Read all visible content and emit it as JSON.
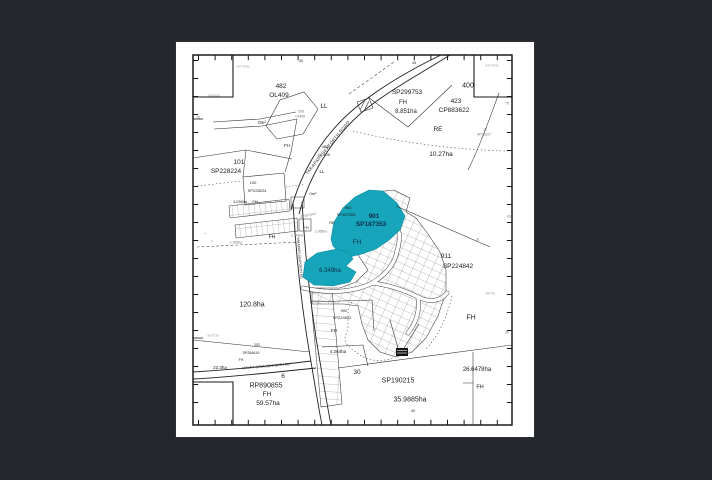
{
  "map": {
    "highlight_color": "#16a5ba",
    "highlight_text_color": "#0d2d4a",
    "paper_color": "#ffffff",
    "background_color": "#24272c",
    "line_color": "#2b2b2b",
    "labels": [
      {
        "t": "482",
        "x": 281,
        "y": 87,
        "s": 6.5,
        "n": "lot-482-number"
      },
      {
        "t": "OL409",
        "x": 279,
        "y": 96,
        "s": 6.5,
        "n": "lot-482-plan"
      },
      {
        "t": "LL",
        "x": 324,
        "y": 107,
        "s": 6,
        "n": "tenure-ll-label"
      },
      {
        "t": "SP299753",
        "x": 407,
        "y": 93,
        "s": 6.5,
        "n": "lot-sp299753-plan"
      },
      {
        "t": "FH",
        "x": 403,
        "y": 103,
        "s": 6,
        "n": "tenure-fh-label"
      },
      {
        "t": "8.851ha",
        "x": 406,
        "y": 112,
        "s": 6,
        "n": "area-8851-label"
      },
      {
        "t": "423",
        "x": 456,
        "y": 102,
        "s": 6.5,
        "n": "lot-423-number"
      },
      {
        "t": "CP883622",
        "x": 454,
        "y": 111,
        "s": 6.5,
        "n": "lot-423-plan"
      },
      {
        "t": "400",
        "x": 468,
        "y": 86,
        "s": 7,
        "n": "lot-400-number"
      },
      {
        "t": "RE",
        "x": 438,
        "y": 130,
        "s": 6.5,
        "n": "tenure-re-label"
      },
      {
        "t": "10.27ha",
        "x": 441,
        "y": 155,
        "s": 6.5,
        "n": "area-1027-label"
      },
      {
        "t": "19",
        "x": 485,
        "y": 130,
        "s": 3.4,
        "c": "#777777"
      },
      {
        "t": "AP22627",
        "x": 484,
        "y": 135,
        "s": 3.4,
        "c": "#777777"
      },
      {
        "t": "101",
        "x": 239,
        "y": 163,
        "s": 6.5,
        "n": "lot-101-number"
      },
      {
        "t": "SP228224",
        "x": 226,
        "y": 172,
        "s": 6.5,
        "n": "lot-101-plan"
      },
      {
        "t": "100",
        "x": 253,
        "y": 183,
        "s": 4
      },
      {
        "t": "SP228224",
        "x": 257,
        "y": 191,
        "s": 4
      },
      {
        "t": "FH",
        "x": 255,
        "y": 202,
        "s": 4
      },
      {
        "t": "0m²",
        "x": 262,
        "y": 123,
        "s": 4.5
      },
      {
        "t": "FH",
        "x": 287,
        "y": 146,
        "s": 4.5
      },
      {
        "t": "598",
        "x": 301,
        "y": 112,
        "s": 3.4,
        "c": "#777777"
      },
      {
        "t": "C4408",
        "x": 300,
        "y": 117,
        "s": 3.4,
        "c": "#777777"
      },
      {
        "t": "482",
        "x": 325,
        "y": 147,
        "s": 4
      },
      {
        "t": "OL409",
        "x": 324,
        "y": 155,
        "s": 4
      },
      {
        "t": "LL",
        "x": 322,
        "y": 172,
        "s": 4.5
      },
      {
        "t": "0m²",
        "x": 313,
        "y": 194,
        "s": 4
      },
      {
        "t": "903",
        "x": 348,
        "y": 208,
        "s": 4
      },
      {
        "t": "SP187353",
        "x": 346,
        "y": 215,
        "s": 4
      },
      {
        "t": "SP187343",
        "x": 308,
        "y": 216,
        "s": 3.4,
        "c": "#777777",
        "r": -12
      },
      {
        "t": "RE",
        "x": 332,
        "y": 223,
        "s": 4
      },
      {
        "t": "FH",
        "x": 306,
        "y": 228,
        "s": 4
      },
      {
        "t": "2.343ha",
        "x": 297,
        "y": 236,
        "s": 3.4,
        "c": "#777777"
      },
      {
        "t": "2.066ha",
        "x": 321,
        "y": 232,
        "s": 3.4,
        "c": "#777777"
      },
      {
        "t": "901",
        "x": 374,
        "y": 217,
        "s": 6.5,
        "c": "#0d2d4a",
        "b": 1,
        "n": "highlight-lot-901-number"
      },
      {
        "t": "SP187353",
        "x": 371,
        "y": 225,
        "s": 6.5,
        "c": "#0d2d4a",
        "b": 1,
        "n": "highlight-lot-901-plan"
      },
      {
        "t": "FH",
        "x": 357,
        "y": 243,
        "s": 6.5,
        "c": "#0d2d4a",
        "n": "highlight-lot-901-tenure"
      },
      {
        "t": "6.349ha",
        "x": 330,
        "y": 271,
        "s": 6,
        "c": "#0d2d4a",
        "n": "highlight-lot-area"
      },
      {
        "t": "911",
        "x": 446,
        "y": 257,
        "s": 6.5,
        "n": "lot-911-number"
      },
      {
        "t": "SP224842",
        "x": 458,
        "y": 267,
        "s": 6.5,
        "n": "lot-911-plan"
      },
      {
        "t": "3L",
        "x": 478,
        "y": 240,
        "s": 3.4,
        "c": "#777777"
      },
      {
        "t": "187ha",
        "x": 490,
        "y": 294,
        "s": 3.4,
        "c": "#999999"
      },
      {
        "t": "FH",
        "x": 471,
        "y": 318,
        "s": 7,
        "n": "tenure-fh-east"
      },
      {
        "t": "120.8ha",
        "x": 252,
        "y": 305,
        "s": 7,
        "n": "area-1208-label"
      },
      {
        "t": "4.036ha",
        "x": 240,
        "y": 203,
        "s": 3.8
      },
      {
        "t": "FH",
        "x": 272,
        "y": 238,
        "s": 5
      },
      {
        "t": "1.009ha",
        "x": 236,
        "y": 243,
        "s": 3.4,
        "c": "#777777"
      },
      {
        "t": "900",
        "x": 344,
        "y": 311,
        "s": 4
      },
      {
        "t": "SP224842",
        "x": 342,
        "y": 318,
        "s": 4
      },
      {
        "t": "FH",
        "x": 334,
        "y": 331,
        "s": 4.5
      },
      {
        "t": "4.264ha",
        "x": 338,
        "y": 352,
        "s": 4.5
      },
      {
        "t": "202",
        "x": 257,
        "y": 346,
        "s": 3.6
      },
      {
        "t": "SP264619",
        "x": 251,
        "y": 354,
        "s": 3.6
      },
      {
        "t": "FH",
        "x": 241,
        "y": 361,
        "s": 3.6
      },
      {
        "t": "22.3ha",
        "x": 220,
        "y": 368,
        "s": 4.5,
        "n": "area-223-label"
      },
      {
        "t": "6",
        "x": 283,
        "y": 377,
        "s": 6.5,
        "n": "lot-6-number"
      },
      {
        "t": "RP890855",
        "x": 266,
        "y": 386,
        "s": 7,
        "n": "lot-6-plan"
      },
      {
        "t": "FH",
        "x": 267,
        "y": 395,
        "s": 6.5
      },
      {
        "t": "59.57ha",
        "x": 268,
        "y": 404,
        "s": 6.5,
        "n": "area-5957-label"
      },
      {
        "t": "30",
        "x": 357,
        "y": 373,
        "s": 6.5,
        "n": "lot-30-number"
      },
      {
        "t": "SP190215",
        "x": 398,
        "y": 381,
        "s": 7,
        "n": "lot-30-plan"
      },
      {
        "t": "35.9885ha",
        "x": 410,
        "y": 400,
        "s": 7,
        "n": "area-359885-label"
      },
      {
        "t": "26.6478ha",
        "x": 477,
        "y": 370,
        "s": 6,
        "n": "area-266478-label"
      },
      {
        "t": "FH",
        "x": 480,
        "y": 388,
        "s": 5.5
      },
      {
        "t": "40",
        "x": 301,
        "y": 61,
        "s": 4,
        "c": "#333333",
        "n": "border-tick-label"
      },
      {
        "t": "45",
        "x": 414,
        "y": 63,
        "s": 4,
        "c": "#333333",
        "n": "border-tick-label"
      },
      {
        "t": "40",
        "x": 413,
        "y": 411,
        "s": 4,
        "c": "#333333",
        "n": "border-tick-label"
      },
      {
        "t": "75",
        "x": 198,
        "y": 118,
        "s": 3.4,
        "c": "#777777"
      },
      {
        "t": "75",
        "x": 507,
        "y": 104,
        "s": 3.4,
        "c": "#777777"
      },
      {
        "t": "63",
        "x": 509,
        "y": 217,
        "s": 3.4,
        "c": "#777777"
      },
      {
        "t": "60",
        "x": 507,
        "y": 333,
        "s": 3.4,
        "c": "#777777"
      },
      {
        "t": "347°5730",
        "x": 243,
        "y": 67,
        "s": 3,
        "c": "#888888",
        "n": "bearing-label"
      },
      {
        "t": "90°5730",
        "x": 214,
        "y": 96,
        "s": 3,
        "c": "#888888",
        "n": "bearing-label"
      },
      {
        "t": "347°5730",
        "x": 492,
        "y": 66,
        "s": 3,
        "c": "#888888",
        "n": "bearing-label"
      },
      {
        "t": "90°5730",
        "x": 213,
        "y": 336,
        "s": 3,
        "c": "#888888",
        "n": "bearing-label"
      },
      {
        "t": "+",
        "x": 205,
        "y": 234,
        "s": 4,
        "c": "#888888"
      },
      {
        "t": "×",
        "x": 212,
        "y": 241,
        "s": 4,
        "c": "#888888"
      },
      {
        "t": "YAKAPARI SEAFORTH ROAD",
        "x": 328,
        "y": 148,
        "s": 4.3,
        "r": -51,
        "ls": 0.4,
        "n": "road-name-yakapari-seaforth"
      },
      {
        "t": "YAKAPARI SEAFORTH RD",
        "x": 299,
        "y": 258,
        "s": 3.4,
        "r": 85,
        "n": "road-name-yakapari-vertical"
      },
      {
        "t": "MOUNT OSSA SEAFORTH RD",
        "x": 266,
        "y": 367,
        "s": 3.4,
        "r": -5,
        "n": "road-name-mount-ossa-seaforth"
      }
    ]
  }
}
